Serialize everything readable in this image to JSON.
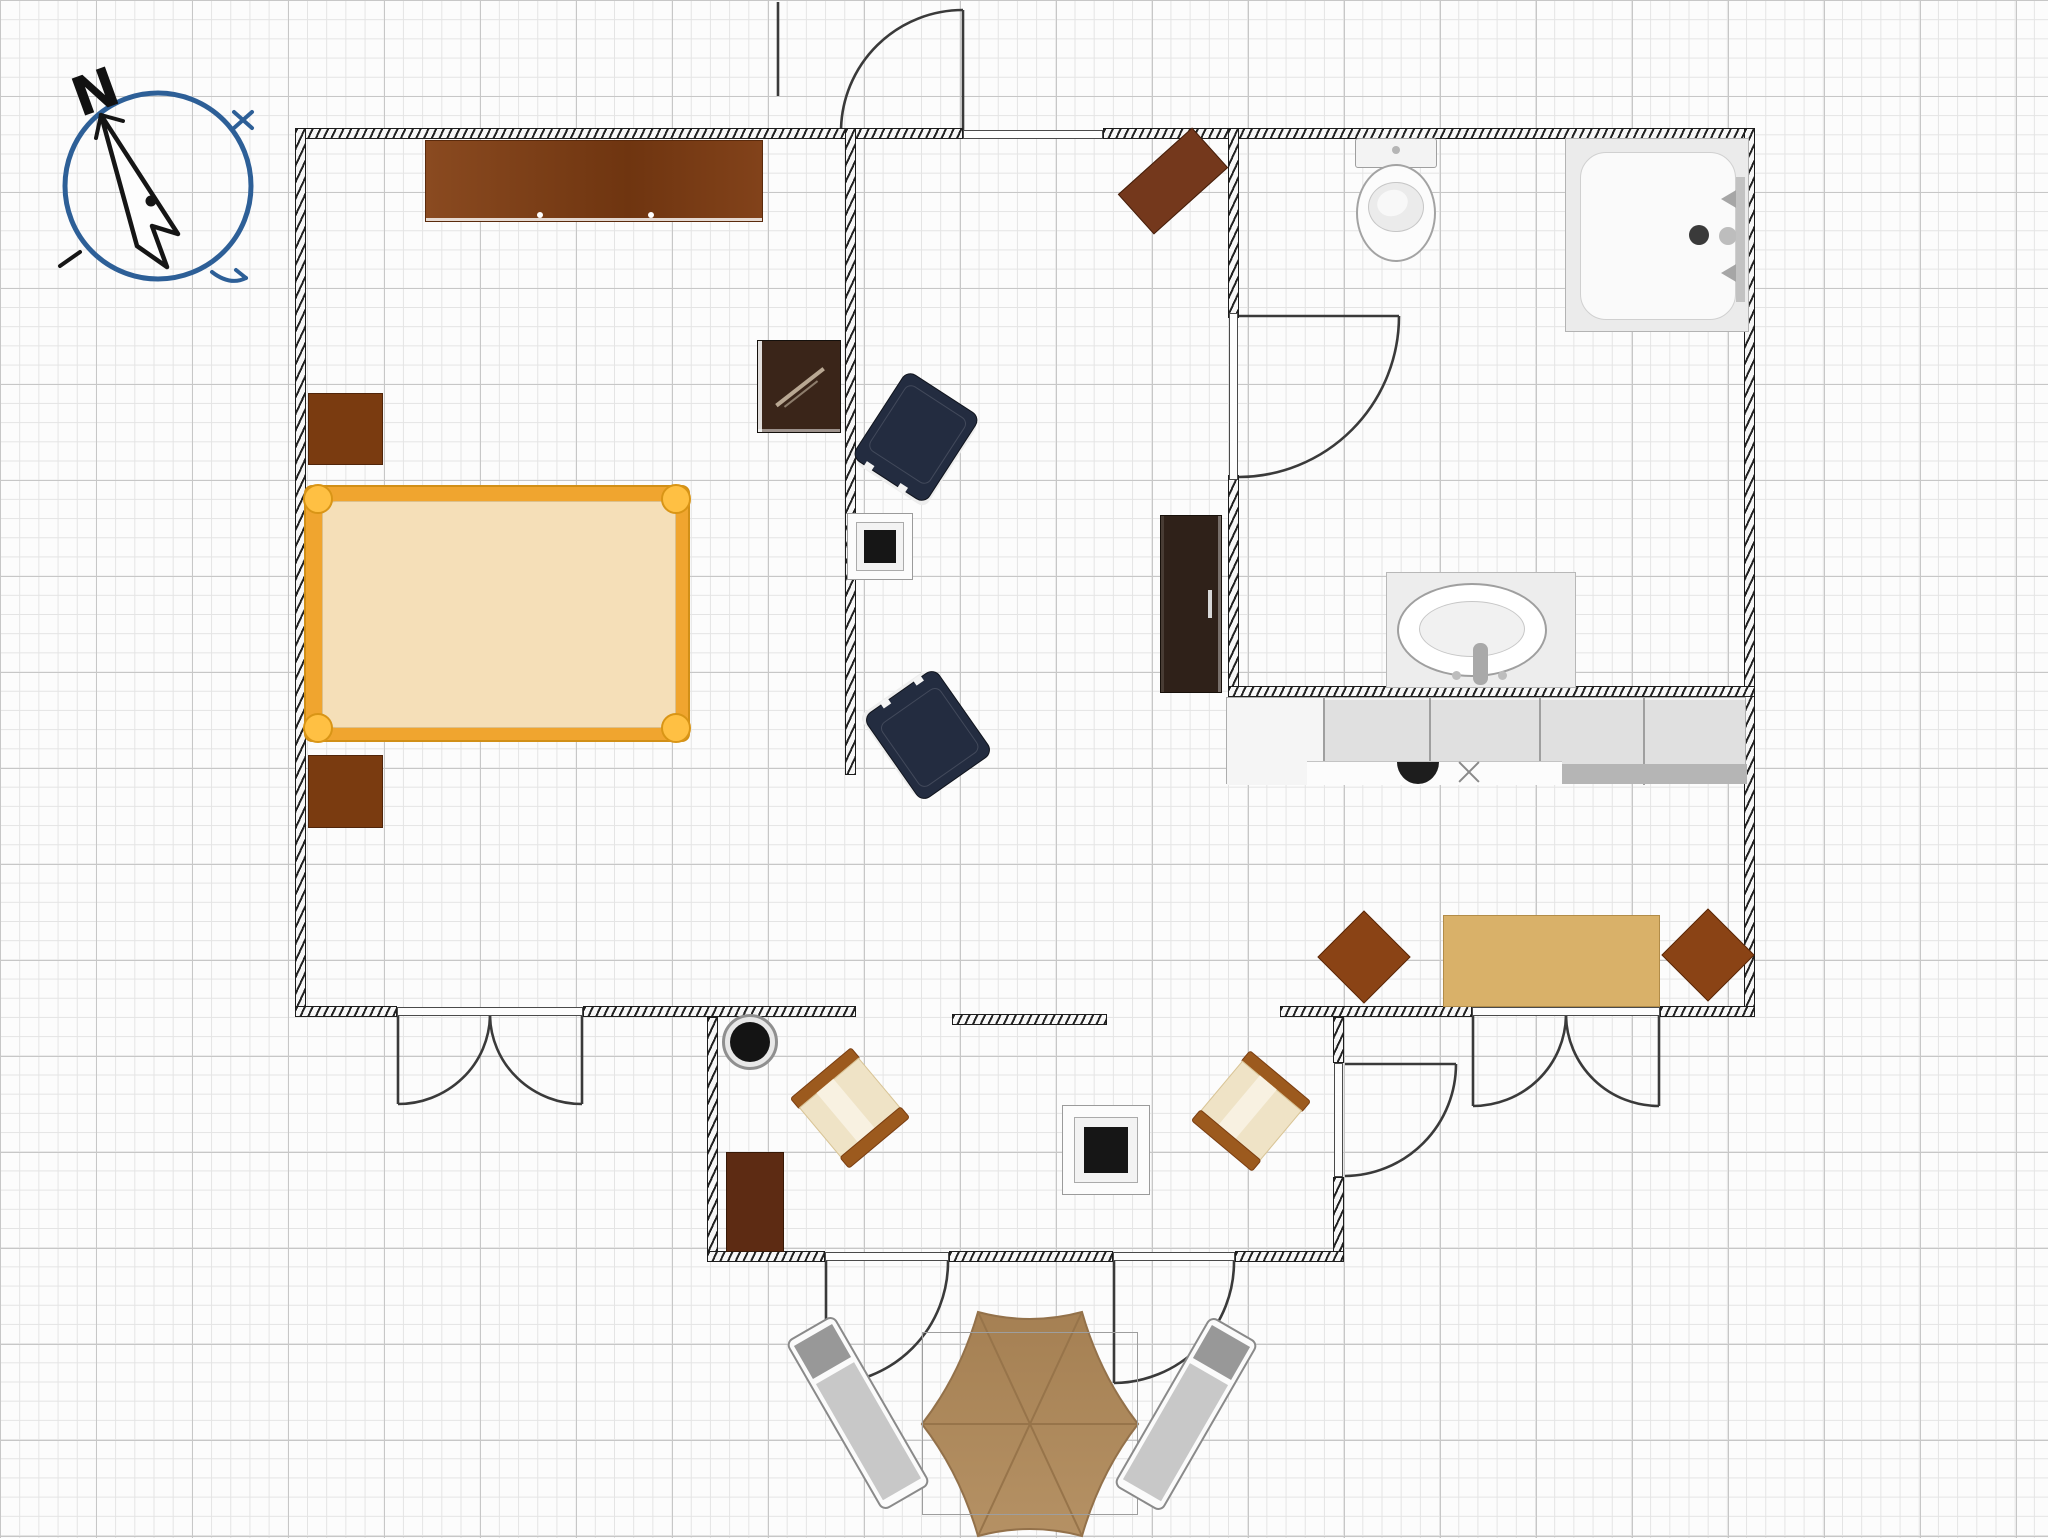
{
  "compass": {
    "label": "N",
    "cx": 158,
    "cy": 186,
    "r": 93,
    "ring": "#2d5f97",
    "ink": "#151515",
    "needle": "M101,115 L178,234 L152,226 L167,267 L137,246 Z",
    "barbs": [
      "M101,115 L123,121",
      "M101,115 L96,138"
    ],
    "dot": [
      151,
      201,
      5.5
    ],
    "marks_blue": [
      "M234,112 L252,128",
      "M252,112 L234,128",
      "M212,272 Q230,286 246,278",
      "M246,278 L236,270"
    ],
    "marks_dark": [
      "M60,266 L80,252"
    ],
    "label_pos": [
      70,
      112,
      54,
      -20,
      90,
      85
    ]
  },
  "canvas": {
    "w": 2048,
    "h": 1538,
    "bg": "#fcfcfc",
    "grid_minor": "#e4e4e4",
    "grid_major": "#c7c7c7"
  },
  "palette": {
    "wall_ink": "#1d1d1d",
    "door_ink": "#3a3a3a",
    "wood_dark": "#7a3b10",
    "wood_mid": "#83431b",
    "wood_red": "#74381c",
    "bed_frame": "#f0a52f",
    "bed_mattress": "#f5dfb8",
    "navy": "#232c40",
    "tan_table": "#d9b169",
    "chair_brown": "#8a4315",
    "wicker_frame": "#9c5a1e",
    "wicker_cushion": "#efe3c6",
    "parasol": "#b59164",
    "lounge_gray": "#c8c8c8"
  },
  "walls": [
    {
      "name": "wall-top-left",
      "x": 295,
      "y": 128,
      "w": 668,
      "h": 11
    },
    {
      "name": "wall-top-right",
      "x": 1103,
      "y": 128,
      "w": 652,
      "h": 11
    },
    {
      "name": "wall-left",
      "x": 295,
      "y": 128,
      "w": 11,
      "h": 889
    },
    {
      "name": "wall-right",
      "x": 1744,
      "y": 128,
      "w": 11,
      "h": 889
    },
    {
      "name": "wall-divider-bedroom",
      "x": 845,
      "y": 128,
      "w": 11,
      "h": 647
    },
    {
      "name": "wall-bathroom-left-upper",
      "x": 1228,
      "y": 128,
      "w": 11,
      "h": 190
    },
    {
      "name": "wall-bathroom-left-lower",
      "x": 1228,
      "y": 475,
      "w": 11,
      "h": 222
    },
    {
      "name": "wall-bathroom-bottom",
      "x": 1228,
      "y": 686,
      "w": 527,
      "h": 11
    },
    {
      "name": "wall-bedroom-bottom-left",
      "x": 295,
      "y": 1006,
      "w": 102,
      "h": 11
    },
    {
      "name": "wall-bedroom-bottom-right",
      "x": 583,
      "y": 1006,
      "w": 273,
      "h": 11
    },
    {
      "name": "wall-terrace-top",
      "x": 952,
      "y": 1014,
      "w": 155,
      "h": 11
    },
    {
      "name": "wall-dining-bottom-left",
      "x": 1280,
      "y": 1006,
      "w": 192,
      "h": 11
    },
    {
      "name": "wall-dining-bottom-right",
      "x": 1660,
      "y": 1006,
      "w": 95,
      "h": 11
    },
    {
      "name": "wall-terrace-left",
      "x": 707,
      "y": 1017,
      "w": 11,
      "h": 245
    },
    {
      "name": "wall-terrace-right-upper",
      "x": 1333,
      "y": 1017,
      "w": 11,
      "h": 46
    },
    {
      "name": "wall-terrace-right-lower",
      "x": 1333,
      "y": 1177,
      "w": 11,
      "h": 85
    },
    {
      "name": "wall-terrace-bottom-1",
      "x": 707,
      "y": 1251,
      "w": 118,
      "h": 11
    },
    {
      "name": "wall-terrace-bottom-2",
      "x": 949,
      "y": 1251,
      "w": 164,
      "h": 11
    },
    {
      "name": "wall-terrace-bottom-3",
      "x": 1235,
      "y": 1251,
      "w": 109,
      "h": 11
    }
  ],
  "jambs": [
    {
      "name": "entrance-threshold",
      "x": 963,
      "y": 130,
      "w": 140,
      "h": 9
    },
    {
      "name": "bedroom-door-threshold",
      "x": 397,
      "y": 1007,
      "w": 186,
      "h": 9
    },
    {
      "name": "dining-door-threshold",
      "x": 1472,
      "y": 1007,
      "w": 188,
      "h": 9
    },
    {
      "name": "bathroom-door-threshold",
      "x": 1229,
      "y": 313,
      "w": 9,
      "h": 167
    },
    {
      "name": "terrace-door-threshold",
      "x": 1334,
      "y": 1063,
      "w": 9,
      "h": 114
    },
    {
      "name": "patio-door-left-threshold",
      "x": 825,
      "y": 1252,
      "w": 124,
      "h": 9
    },
    {
      "name": "patio-door-right-threshold",
      "x": 1113,
      "y": 1252,
      "w": 122,
      "h": 9
    }
  ],
  "doors": [
    {
      "name": "entrance-door",
      "lines": [
        "M963,130 L963,10",
        "M778,2 L778,96"
      ],
      "arcs": [
        "M841,130 A122,122 0 0 1 963,10"
      ]
    },
    {
      "name": "bathroom-door",
      "lines": [
        "M1239,316 L1399,316"
      ],
      "arcs": [
        "M1399,316 A161,161 0 0 1 1239,477"
      ]
    },
    {
      "name": "terrace-dining-door",
      "lines": [
        "M1345,1064 L1456,1064"
      ],
      "arcs": [
        "M1456,1064 A112,112 0 0 1 1345,1176"
      ]
    },
    {
      "name": "bedroom-french-door",
      "lines": [
        "M398,1016 L398,1104",
        "M582,1016 L582,1104"
      ],
      "arcs": [
        "M490,1016 A92,90 0 0 1 398,1104",
        "M490,1016 A92,90 0 0 0 582,1104"
      ]
    },
    {
      "name": "dining-french-door",
      "lines": [
        "M1473,1016 L1473,1106",
        "M1659,1016 L1659,1106"
      ],
      "arcs": [
        "M1566,1016 A93,92 0 0 1 1473,1106",
        "M1566,1016 A93,92 0 0 0 1659,1106"
      ]
    },
    {
      "name": "patio-door-left",
      "lines": [
        "M826,1261 L826,1384"
      ],
      "arcs": [
        "M948,1261 A122,122 0 0 1 826,1384"
      ]
    },
    {
      "name": "patio-door-right",
      "lines": [
        "M1114,1261 L1114,1383"
      ],
      "arcs": [
        "M1234,1261 A121,121 0 0 1 1114,1383"
      ]
    }
  ],
  "furniture": [
    {
      "name": "wardrobe",
      "kind": "wardrobe",
      "x": 425,
      "y": 140,
      "w": 338,
      "h": 82,
      "fill": "#83431b"
    },
    {
      "name": "nightstand-top",
      "kind": "block",
      "x": 308,
      "y": 393,
      "w": 75,
      "h": 72,
      "fill": "#7a3b10",
      "edge": "#50250a"
    },
    {
      "name": "nightstand-bottom",
      "kind": "block",
      "x": 308,
      "y": 755,
      "w": 75,
      "h": 73,
      "fill": "#7a3b10",
      "edge": "#50250a"
    },
    {
      "name": "double-bed",
      "kind": "bed",
      "x": 304,
      "y": 485,
      "w": 386,
      "h": 257,
      "frame": "#f0a52f",
      "knob": "#ffc043",
      "mattress": "#f5dfb8"
    },
    {
      "name": "tv-bedroom",
      "kind": "tv",
      "x": 757,
      "y": 340,
      "w": 84,
      "h": 93,
      "fill": "#3a2519"
    },
    {
      "name": "armchair-navy-1",
      "kind": "armchair",
      "cx": 916,
      "cy": 437,
      "w": 88,
      "h": 104,
      "rot": 33,
      "fill": "#232c40"
    },
    {
      "name": "armchair-navy-2",
      "kind": "armchair",
      "cx": 928,
      "cy": 735,
      "w": 88,
      "h": 104,
      "rot": 145,
      "fill": "#232c40"
    },
    {
      "name": "side-table-living",
      "kind": "sidetable",
      "x": 847,
      "y": 513,
      "w": 66,
      "h": 67
    },
    {
      "name": "wall-shelf-angled",
      "kind": "block",
      "cx": 1173,
      "cy": 181,
      "w": 100,
      "h": 54,
      "rot": -42,
      "fill": "#74381c",
      "edge": "#451f0b"
    },
    {
      "name": "dresser-living",
      "kind": "dresser",
      "x": 1160,
      "y": 515,
      "w": 62,
      "h": 178,
      "fill": "#2f2119",
      "edge": "#17100a"
    },
    {
      "name": "toilet",
      "kind": "toilet",
      "x": 1353,
      "y": 138,
      "w": 86,
      "h": 126
    },
    {
      "name": "shower",
      "kind": "shower",
      "x": 1565,
      "y": 138,
      "w": 184,
      "h": 194
    },
    {
      "name": "sink-vanity",
      "kind": "sink",
      "x": 1386,
      "y": 572,
      "w": 190,
      "h": 116
    },
    {
      "name": "kitchen-counter",
      "kind": "counter",
      "x": 1226,
      "y": 697,
      "w": 520,
      "h": 87,
      "dividers": [
        96,
        202,
        312,
        416
      ],
      "sink_cx": 191,
      "burner_cx": 242
    },
    {
      "name": "dining-table",
      "kind": "block",
      "x": 1443,
      "y": 915,
      "w": 217,
      "h": 92,
      "fill": "#d9b169",
      "edge": "#b28c48"
    },
    {
      "name": "dining-chair-1",
      "kind": "block",
      "cx": 1364,
      "cy": 957,
      "w": 66,
      "h": 66,
      "rot": 45,
      "fill": "#8a4315",
      "edge": "#5b2809"
    },
    {
      "name": "dining-chair-2",
      "kind": "block",
      "cx": 1708,
      "cy": 955,
      "w": 66,
      "h": 66,
      "rot": 45,
      "fill": "#8a4315",
      "edge": "#5b2809"
    },
    {
      "name": "plant-pot",
      "kind": "pot",
      "cx": 750,
      "cy": 1042
    },
    {
      "name": "wicker-chair-1",
      "kind": "wicker",
      "cx": 850,
      "cy": 1108,
      "w": 80,
      "h": 92,
      "rot": -40
    },
    {
      "name": "wicker-chair-2",
      "kind": "wicker",
      "cx": 1251,
      "cy": 1111,
      "w": 80,
      "h": 92,
      "rot": 40
    },
    {
      "name": "side-table-terrace",
      "kind": "sidetable",
      "x": 1062,
      "y": 1105,
      "w": 88,
      "h": 90
    },
    {
      "name": "dresser-terrace",
      "kind": "block",
      "x": 726,
      "y": 1152,
      "w": 58,
      "h": 100,
      "fill": "#5d2b13",
      "edge": "#371806"
    },
    {
      "name": "patio-outline",
      "kind": "outline",
      "x": 922,
      "y": 1332,
      "w": 216,
      "h": 183
    },
    {
      "name": "lounge-chair-1",
      "kind": "lounge",
      "cx": 858,
      "cy": 1413,
      "w": 56,
      "h": 196,
      "rot": -30
    },
    {
      "name": "lounge-chair-2",
      "kind": "lounge",
      "cx": 1186,
      "cy": 1414,
      "w": 56,
      "h": 196,
      "rot": 30
    }
  ],
  "umbrella": {
    "name": "parasol",
    "path": "M922,1424 Q960,1375 978,1312 Q1030,1326 1082,1312 Q1100,1375 1138,1424 Q1100,1473 1082,1536 Q1030,1522 978,1536 Q960,1473 922,1424 Z",
    "center": [
      1030,
      1424
    ],
    "vertices": [
      [
        922,
        1424
      ],
      [
        978,
        1312
      ],
      [
        1082,
        1312
      ],
      [
        1138,
        1424
      ],
      [
        1082,
        1536
      ],
      [
        978,
        1536
      ]
    ],
    "fill_top": "#a58053",
    "fill_bottom": "#b59164",
    "crease": "#97744a",
    "stroke": "#93714a"
  }
}
